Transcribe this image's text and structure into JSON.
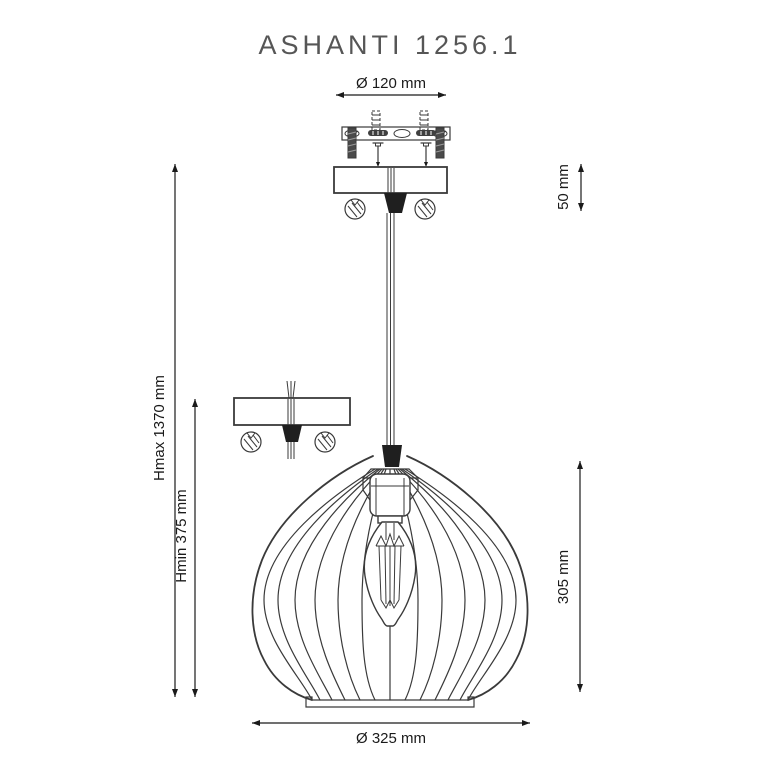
{
  "title": "ASHANTI 1256.1",
  "dimensions": {
    "top_diameter": "Ø 120 mm",
    "canopy_height": "50 mm",
    "hmax": "Hmax 1370 mm",
    "hmin": "Hmin 375 mm",
    "shade_height": "305 mm",
    "bottom_diameter": "Ø 325 mm"
  },
  "colors": {
    "background": "#ffffff",
    "line": "#3a3a3a",
    "dim": "#1a1a1a",
    "title": "#565656",
    "grip": "#1f1f1f"
  }
}
